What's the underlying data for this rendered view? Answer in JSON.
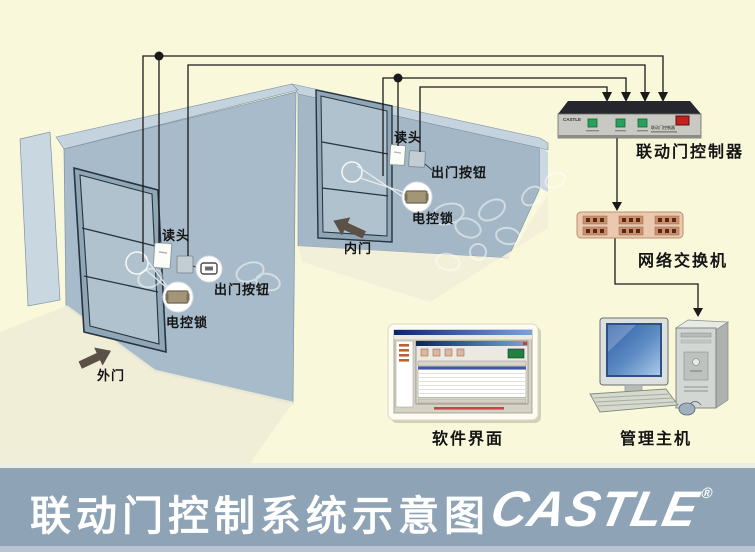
{
  "banner": {
    "title": "联动门控制系统示意图",
    "logo_text": "CASTLE",
    "registered_mark": "®",
    "bar_color": "#8EA4B6",
    "text_color": "#FFFFFF"
  },
  "diagram": {
    "background_color": "#FAF8DB",
    "wall_color": "#A7BBCA",
    "wire_color": "#1A1A1A",
    "outer_door": {
      "door_label": "外门",
      "reader_label": "读头",
      "exit_button_label": "出门按钮",
      "lock_label": "电控锁"
    },
    "inner_door": {
      "door_label": "内门",
      "reader_label": "读头",
      "exit_button_label": "出门按钮",
      "lock_label": "电控锁"
    },
    "controller": {
      "label": "联动门控制器",
      "brand": "CASTLE",
      "device_text": "联动门控制器",
      "button_color": "#2BA05C",
      "switch_color": "#C42020"
    },
    "network_switch": {
      "label": "网络交换机",
      "body_color": "#EAC9AF"
    },
    "software": {
      "label": "软件界面"
    },
    "host": {
      "label": "管理主机",
      "screen_color": "#4878B8"
    }
  }
}
